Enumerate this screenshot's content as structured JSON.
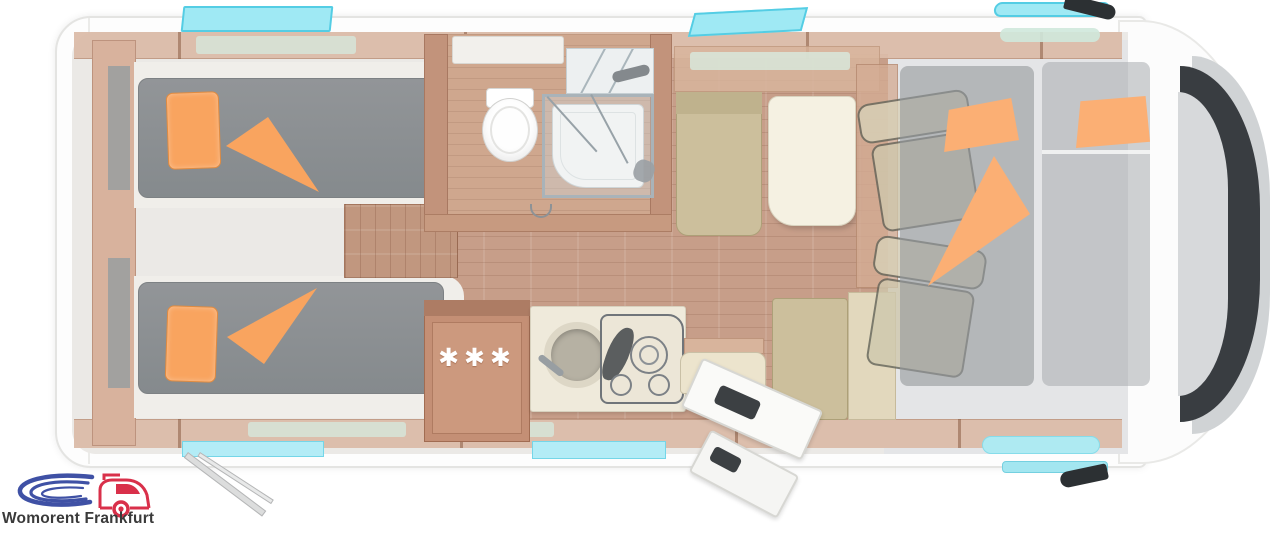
{
  "logo": {
    "text": "Womorent Frankfurt",
    "swoosh_color": "#3f51a5",
    "van_color": "#d9304a",
    "text_color": "#3a3a3a"
  },
  "floorplan": {
    "type": "motorhome-top-down-floor-plan",
    "fridge_stars": "✱✱✱",
    "palette": {
      "vehicle_body": "#fdfdfd",
      "interior_floor": "#ebe9e6",
      "wood_floor": "#c79e89",
      "wood_wall": "#dcbca9",
      "wood_furniture": "#c48f75",
      "mattress_gray": "#8c8f92",
      "bedding_orange": "#f9a45f",
      "upholstery_beige": "#ccbf9c",
      "table_cream": "#f5f1e2",
      "window_cyan": "#9fe9f4",
      "windshield_dark": "#393d41"
    },
    "features": [
      "twin-single-beds-rear",
      "orange-pillows-and-blankets",
      "bathroom-with-toilet",
      "separate-shower-cabin",
      "steps-between-beds",
      "fridge-with-three-star-freezer",
      "kitchen-round-sink",
      "three-burner-gas-hob",
      "dinette-with-table-and-benches",
      "entry-door-open",
      "drop-down-bed-over-cab",
      "two-cab-seats",
      "roof-windows-and-skylights",
      "awning-support-leg",
      "cab-mirrors"
    ]
  }
}
